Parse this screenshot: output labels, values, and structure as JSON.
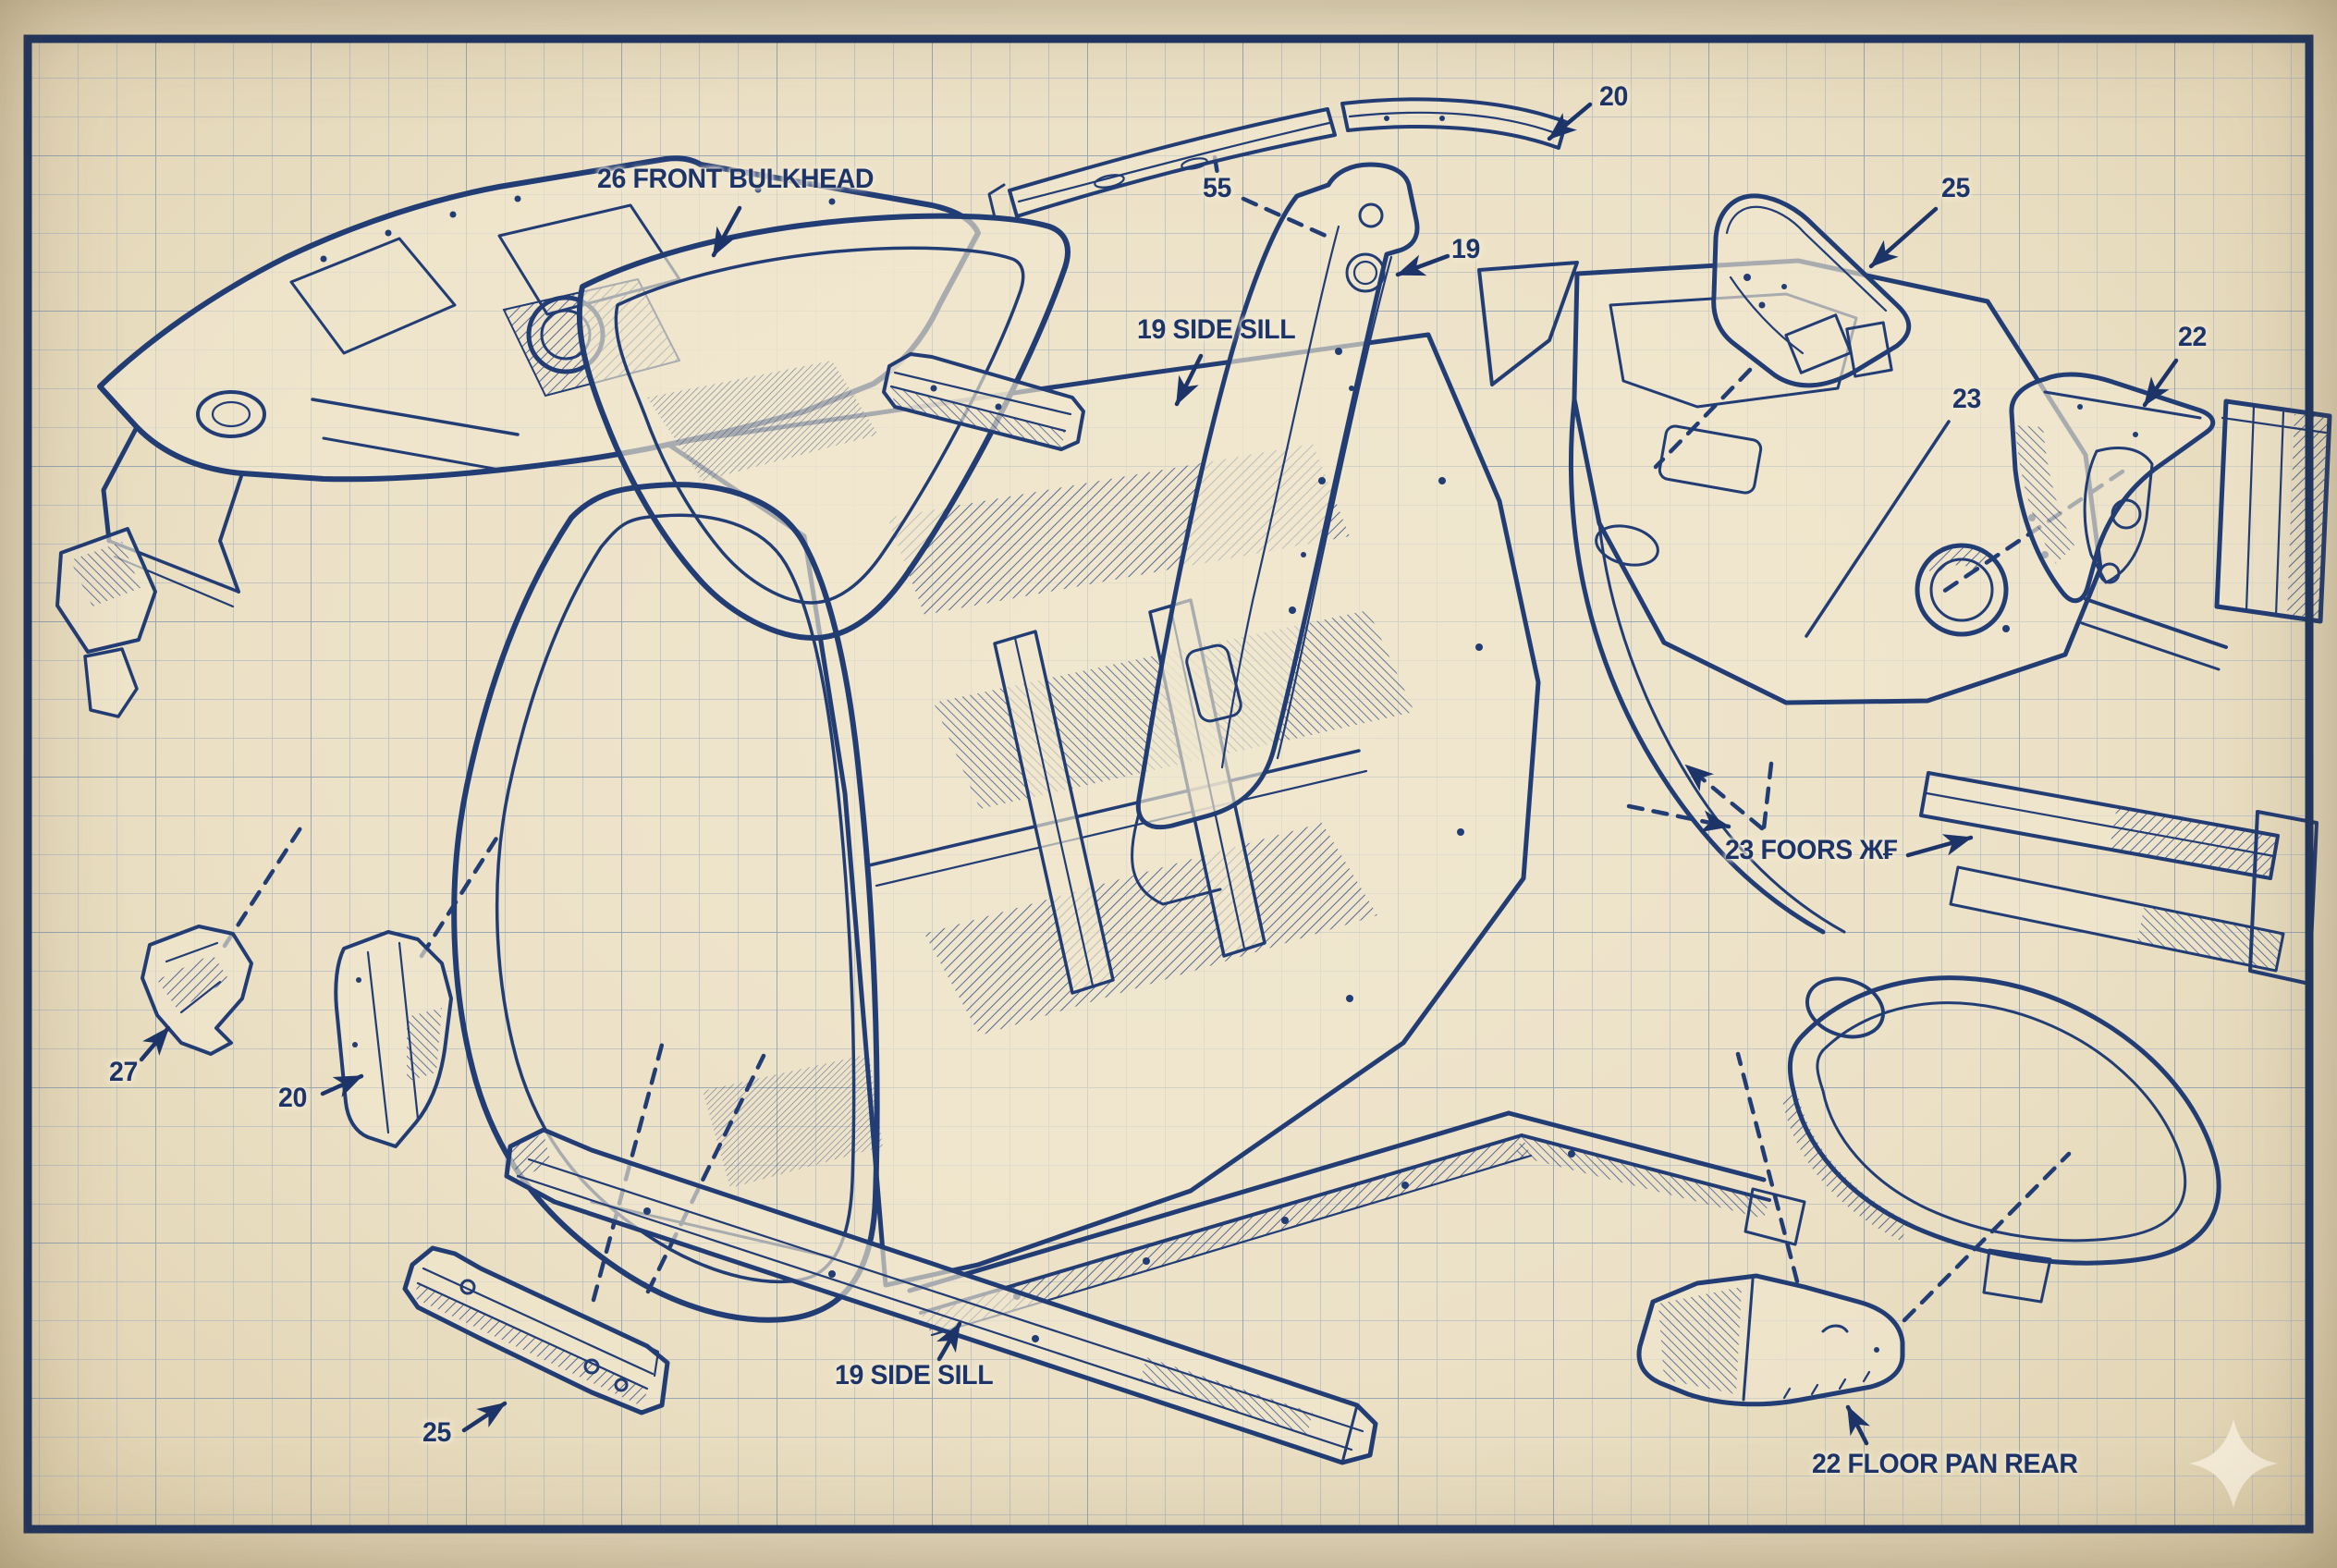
{
  "blueprint": {
    "style": {
      "paper_color": "#ece2c8",
      "ink_color": "#223c74",
      "label_color": "#1d3469",
      "grid_minor_color": "#a3b0c2",
      "grid_major_color": "#7f92a8",
      "border_color": "#1c3464",
      "watermark_color": "#f5edda"
    },
    "icons": {
      "watermark": "four-point-sparkle"
    },
    "labels": [
      {
        "id": "front-bulkhead-label",
        "text": "26 FRONT BULKHEAD"
      },
      {
        "id": "roof-rail-label",
        "text": "20"
      },
      {
        "id": "label-55",
        "text": "55"
      },
      {
        "id": "b-pillar-label",
        "text": "19"
      },
      {
        "id": "side-sill-upper-label",
        "text": "19 SIDE SILL"
      },
      {
        "id": "quarter-upper-label",
        "text": "25"
      },
      {
        "id": "bracket-right-label",
        "text": "22"
      },
      {
        "id": "shock-tower-label",
        "text": "23"
      },
      {
        "id": "floors-label",
        "text": "23 FOORS Ж₣"
      },
      {
        "id": "bracket-lower-left-label",
        "text": "27"
      },
      {
        "id": "channel-lower-left-label",
        "text": "20"
      },
      {
        "id": "channel-bottom-label",
        "text": "25"
      },
      {
        "id": "side-sill-lower-label",
        "text": "19 SIDE SILL"
      },
      {
        "id": "floor-pan-rear-label",
        "text": "22 FLOOR PAN REAR"
      }
    ]
  }
}
